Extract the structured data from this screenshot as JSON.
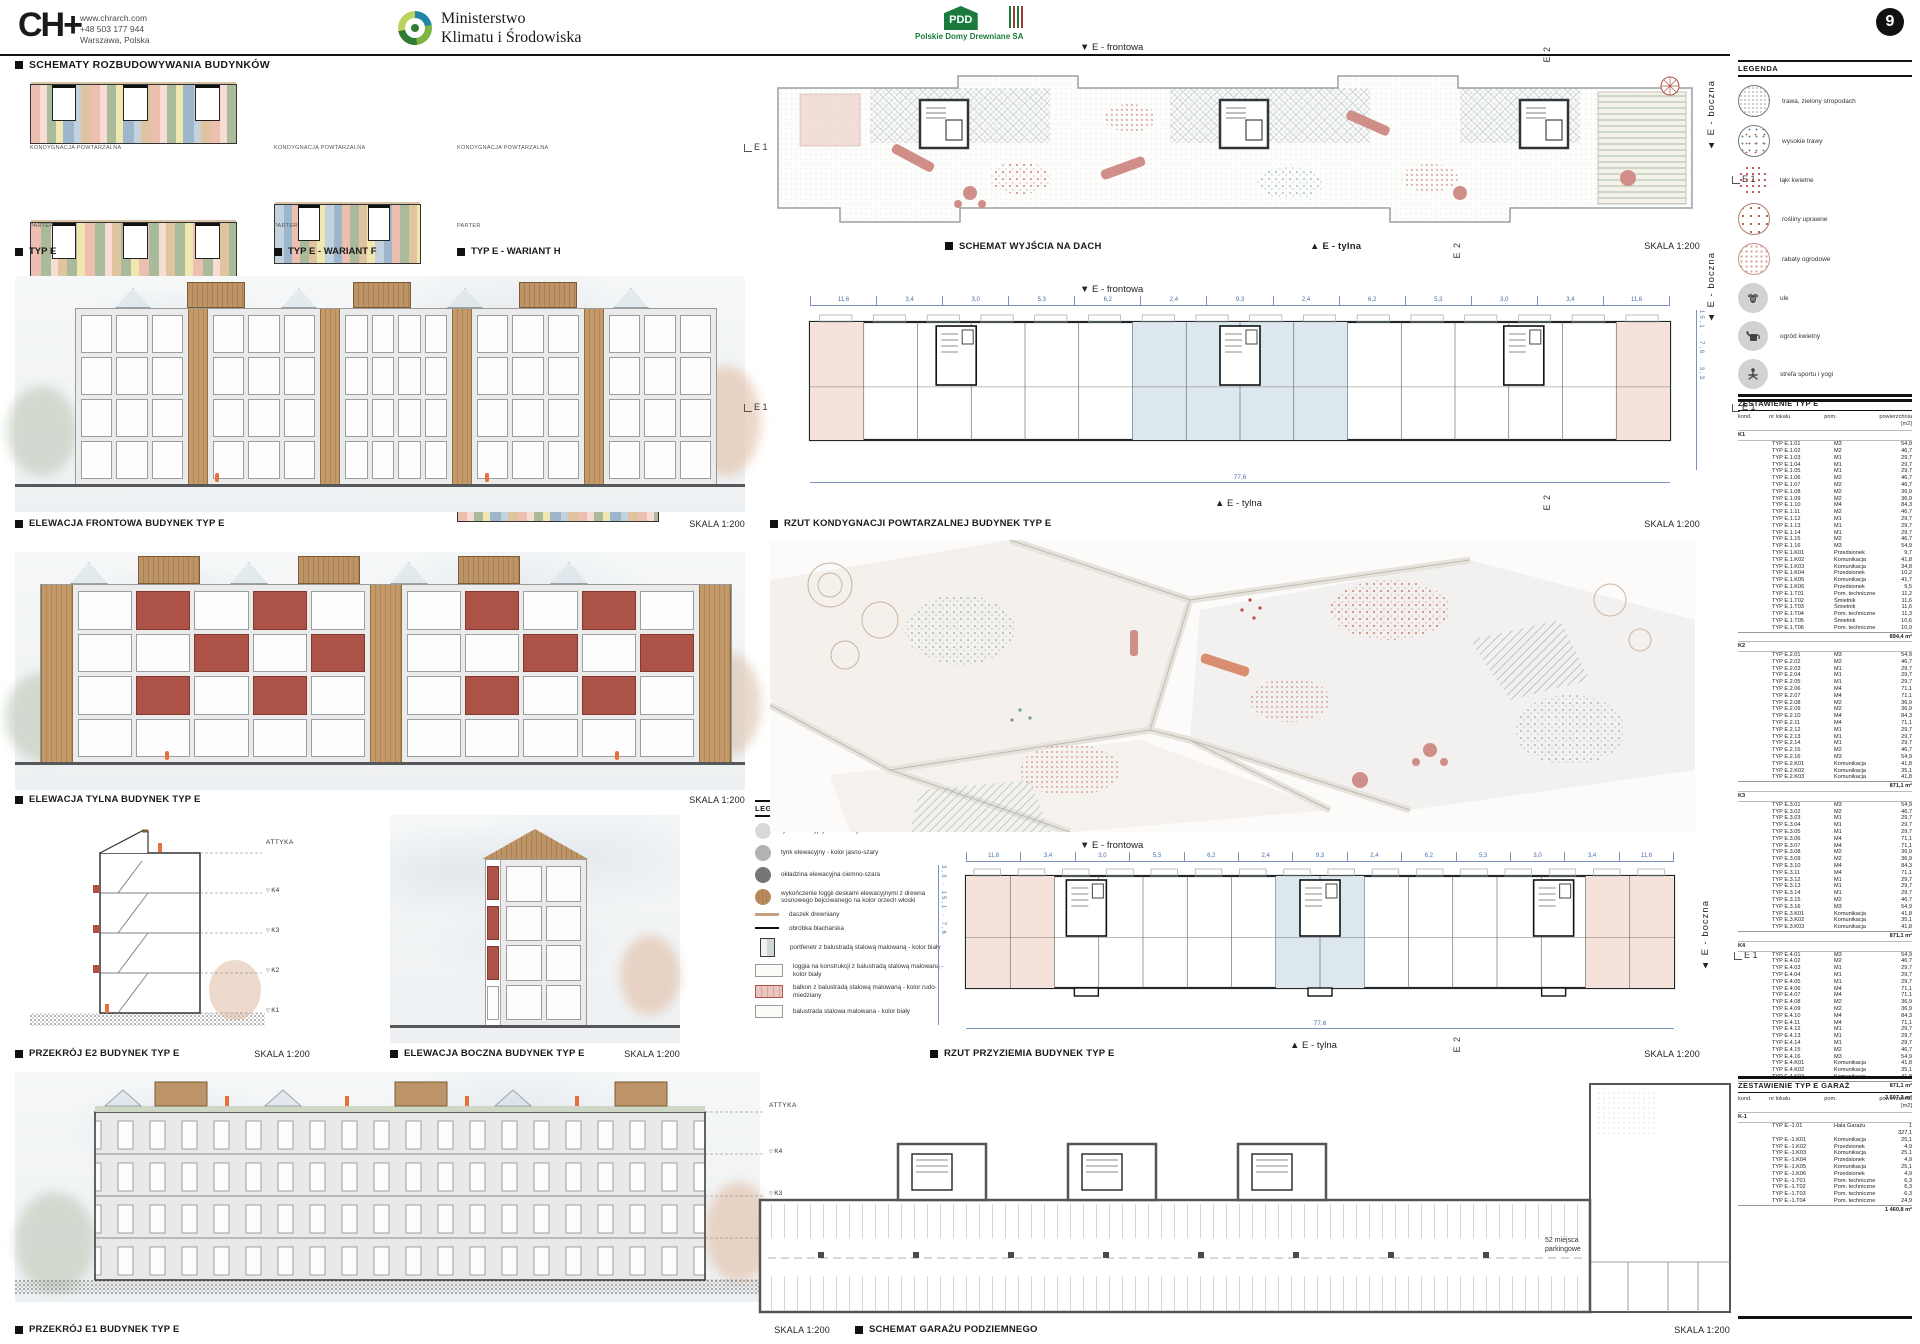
{
  "page": {
    "number": "9"
  },
  "header": {
    "logo": "CH",
    "logo_plus": "+",
    "contact": [
      "www.chrarch.com",
      "+48 503 177 944",
      "Warszawa, Polska"
    ],
    "ministry_line1": "Ministerstwo",
    "ministry_line2": "Klimatu i Środowiska",
    "pdd_abbr": "PDD",
    "pdd_name": "Polskie Domy Drewniane SA"
  },
  "titles": {
    "schematy": "SCHEMATY ROZBUDOWYWANIA BUDYNKÓW"
  },
  "figures": {
    "typ_e": {
      "caption": "TYP E"
    },
    "wariant_f": {
      "caption": "TYP E - WARIANT F"
    },
    "wariant_h": {
      "caption": "TYP E - WARIANT H"
    },
    "elew_front": {
      "caption": "ELEWACJA FRONTOWA BUDYNEK TYP E",
      "scale": "SKALA 1:200"
    },
    "elew_tylna": {
      "caption": "ELEWACJA TYLNA BUDYNEK TYP E",
      "scale": "SKALA 1:200"
    },
    "przekroj_e2": {
      "caption": "PRZEKRÓJ E2 BUDYNEK TYP E",
      "scale": "SKALA 1:200"
    },
    "elew_boczna": {
      "caption": "ELEWACJA BOCZNA BUDYNEK TYP E",
      "scale": "SKALA 1:200"
    },
    "przekroj_e1": {
      "caption": "PRZEKRÓJ E1 BUDYNEK TYP E",
      "scale": "SKALA 1:200"
    },
    "dach": {
      "caption": "SCHEMAT WYJŚCIA NA DACH",
      "scale": "SKALA 1:200"
    },
    "rzut_powt": {
      "caption": "RZUT KONDYGNACJI POWTARZALNEJ BUDYNEK TYP E",
      "scale": "SKALA 1:200"
    },
    "rzut_przyz": {
      "caption": "RZUT PRZYZIEMIA BUDYNEK TYP E",
      "scale": "SKALA 1:200"
    },
    "garaz": {
      "caption": "SCHEMAT GARAŻU PODZIEMNEGO",
      "scale": "SKALA 1:200"
    }
  },
  "labels": {
    "kondygnacja": "KONDYGNACJA POWTARZALNA",
    "parter": "PARTER",
    "frontowa": "▼ E - frontowa",
    "tylna": "▲ E - tylna",
    "boczna": "▲ E - boczna",
    "e1": "E 1",
    "e2": "E 2",
    "attyka": "ATTYKA",
    "levels": [
      "K4",
      "K3",
      "K2",
      "K1"
    ],
    "garage_note_1": "52 miejsca",
    "garage_note_2": "parkingowe"
  },
  "dims": {
    "horizontal": [
      "11,6",
      "3,4",
      "3,0",
      "5,3",
      "6,2",
      "2,4",
      "9,3",
      "2,4",
      "6,2",
      "5,3",
      "3,0",
      "3,4",
      "11,6"
    ],
    "total": "77,6",
    "vertical": [
      "3,3",
      "15,1",
      "7,6"
    ]
  },
  "legend_site": {
    "title": "LEGENDA",
    "items": [
      {
        "label": "trawa, zielony stropodach",
        "swatch": "ls-dots-fine"
      },
      {
        "label": "wysokie trawy",
        "swatch": "ls-dots-mix"
      },
      {
        "label": "łąki kwietne",
        "swatch": "ls-dots-red"
      },
      {
        "label": "rośliny uprawne",
        "swatch": "ls-dots-red-c"
      },
      {
        "label": "rabaty ogrodowe",
        "swatch": "ls-dots-pink"
      },
      {
        "label": "ule",
        "swatch": "icon-bee"
      },
      {
        "label": "ogród kwietny",
        "swatch": "icon-can"
      },
      {
        "label": "strefa sportu i yogi",
        "swatch": "icon-yoga"
      }
    ]
  },
  "legend_materials": {
    "title": "LEGENDA",
    "items": [
      {
        "label": "tynk elewacyjny - kolor biały",
        "swatch": "c-light"
      },
      {
        "label": "tynk elewacyjny - kolor jasno-szary",
        "swatch": "c-mid"
      },
      {
        "label": "okładzina elewacyjna ciemno-szara",
        "swatch": "c-dark"
      },
      {
        "label": "wykończenie loggii deskami elewacyjnymi z drewna sosnowego bejcowanego na kolor orzech włoski",
        "swatch": "c-wood"
      },
      {
        "label": "daszek drewniany",
        "swatch": "line-wood"
      },
      {
        "label": "obróbka blacharska",
        "swatch": "line-black"
      },
      {
        "label": "portfenetr z balustradą stalową malowaną - kolor biały",
        "swatch": "sw-window"
      },
      {
        "label": "loggia na konstrukcji z balustradą stalową malowaną - kolor biały",
        "swatch": "sw-box"
      },
      {
        "label": "balkon z balustradą stalową malowaną - kolor rudo-miedziany",
        "swatch": "sw-box red"
      },
      {
        "label": "balustrada stalowa malowana - kolor biały",
        "swatch": "sw-box"
      }
    ]
  },
  "tables": {
    "typ_e": {
      "title": "ZESTAWIENIE TYP E",
      "headers": [
        "kond.",
        "nr lokalu",
        "pom.",
        "powierzchnia [m2]"
      ],
      "groups": [
        {
          "kond": "K1",
          "rows": [
            [
              "TYP E.1.01",
              "M3",
              "54,9"
            ],
            [
              "TYP E.1.02",
              "M2",
              "46,7"
            ],
            [
              "TYP E.1.03",
              "M1",
              "29,7"
            ],
            [
              "TYP E.1.04",
              "M1",
              "29,7"
            ],
            [
              "TYP E.1.05",
              "M1",
              "29,7"
            ],
            [
              "TYP E.1.06",
              "M2",
              "46,7"
            ],
            [
              "TYP E.1.07",
              "M2",
              "46,7"
            ],
            [
              "TYP E.1.08",
              "M2",
              "36,9"
            ],
            [
              "TYP E.1.09",
              "M2",
              "36,9"
            ],
            [
              "TYP E.1.10",
              "M4",
              "84,3"
            ],
            [
              "TYP E.1.11",
              "M2",
              "46,7"
            ],
            [
              "TYP E.1.12",
              "M1",
              "29,7"
            ],
            [
              "TYP E.1.13",
              "M1",
              "29,7"
            ],
            [
              "TYP E.1.14",
              "M1",
              "29,7"
            ],
            [
              "TYP E.1.15",
              "M2",
              "46,7"
            ],
            [
              "TYP E.1.16",
              "M3",
              "54,9"
            ],
            [
              "TYP E.1.K01",
              "Przedsionek",
              "9,7"
            ],
            [
              "TYP E.1.K02",
              "Komunikacja",
              "41,8"
            ],
            [
              "TYP E.1.K03",
              "Komunikacja",
              "34,8"
            ],
            [
              "TYP E.1.K04",
              "Przedsionek",
              "10,2"
            ],
            [
              "TYP E.1.K05",
              "Komunikacja",
              "41,7"
            ],
            [
              "TYP E.1.K06",
              "Przedsionek",
              "9,5"
            ],
            [
              "TYP E.1.T01",
              "Pom. techniczne",
              "11,2"
            ],
            [
              "TYP E.1.T02",
              "Śmietnik",
              "11,6"
            ],
            [
              "TYP E.1.T03",
              "Śmietnik",
              "11,6"
            ],
            [
              "TYP E.1.T04",
              "Pom. techniczne",
              "11,3"
            ],
            [
              "TYP E.1.T05",
              "Śmietnik",
              "10,6"
            ],
            [
              "TYP E.1.T06",
              "Pom. techniczne",
              "10,9"
            ]
          ],
          "subtotal": "894,4 m²"
        },
        {
          "kond": "K2",
          "rows": [
            [
              "TYP E.2.01",
              "M3",
              "54,9"
            ],
            [
              "TYP E.2.02",
              "M2",
              "46,7"
            ],
            [
              "TYP E.2.03",
              "M1",
              "29,7"
            ],
            [
              "TYP E.2.04",
              "M1",
              "29,7"
            ],
            [
              "TYP E.2.05",
              "M1",
              "29,7"
            ],
            [
              "TYP E.2.06",
              "M4",
              "71,1"
            ],
            [
              "TYP E.2.07",
              "M4",
              "71,1"
            ],
            [
              "TYP E.2.08",
              "M2",
              "36,9"
            ],
            [
              "TYP E.2.09",
              "M2",
              "36,9"
            ],
            [
              "TYP E.2.10",
              "M4",
              "84,3"
            ],
            [
              "TYP E.2.11",
              "M4",
              "71,1"
            ],
            [
              "TYP E.2.12",
              "M1",
              "29,7"
            ],
            [
              "TYP E.2.13",
              "M1",
              "29,7"
            ],
            [
              "TYP E.2.14",
              "M1",
              "29,7"
            ],
            [
              "TYP E.2.15",
              "M2",
              "46,7"
            ],
            [
              "TYP E.2.16",
              "M3",
              "54,9"
            ],
            [
              "TYP E.2.K01",
              "Komunikacja",
              "41,8"
            ],
            [
              "TYP E.2.K02",
              "Komunikacja",
              "35,1"
            ],
            [
              "TYP E.2.K03",
              "Komunikacja",
              "41,8"
            ]
          ],
          "subtotal": "871,1 m²"
        },
        {
          "kond": "K3",
          "rows": [
            [
              "TYP E.3.01",
              "M3",
              "54,9"
            ],
            [
              "TYP E.3.02",
              "M2",
              "46,7"
            ],
            [
              "TYP E.3.03",
              "M1",
              "29,7"
            ],
            [
              "TYP E.3.04",
              "M1",
              "29,7"
            ],
            [
              "TYP E.3.05",
              "M1",
              "29,7"
            ],
            [
              "TYP E.3.06",
              "M4",
              "71,1"
            ],
            [
              "TYP E.3.07",
              "M4",
              "71,1"
            ],
            [
              "TYP E.3.08",
              "M2",
              "36,9"
            ],
            [
              "TYP E.3.09",
              "M2",
              "36,9"
            ],
            [
              "TYP E.3.10",
              "M4",
              "84,3"
            ],
            [
              "TYP E.3.11",
              "M4",
              "71,1"
            ],
            [
              "TYP E.3.12",
              "M1",
              "29,7"
            ],
            [
              "TYP E.3.13",
              "M1",
              "29,7"
            ],
            [
              "TYP E.3.14",
              "M1",
              "29,7"
            ],
            [
              "TYP E.3.15",
              "M2",
              "46,7"
            ],
            [
              "TYP E.3.16",
              "M3",
              "54,9"
            ],
            [
              "TYP E.3.K01",
              "Komunikacja",
              "41,8"
            ],
            [
              "TYP E.3.K02",
              "Komunikacja",
              "35,1"
            ],
            [
              "TYP E.3.K03",
              "Komunikacja",
              "41,8"
            ]
          ],
          "subtotal": "871,1 m²"
        },
        {
          "kond": "K4",
          "rows": [
            [
              "TYP E.4.01",
              "M3",
              "54,9"
            ],
            [
              "TYP E.4.02",
              "M2",
              "46,7"
            ],
            [
              "TYP E.4.03",
              "M1",
              "29,7"
            ],
            [
              "TYP E.4.04",
              "M1",
              "29,7"
            ],
            [
              "TYP E.4.05",
              "M1",
              "29,7"
            ],
            [
              "TYP E.4.06",
              "M4",
              "71,1"
            ],
            [
              "TYP E.4.07",
              "M4",
              "71,1"
            ],
            [
              "TYP E.4.08",
              "M2",
              "36,9"
            ],
            [
              "TYP E.4.09",
              "M2",
              "36,9"
            ],
            [
              "TYP E.4.10",
              "M4",
              "84,3"
            ],
            [
              "TYP E.4.11",
              "M4",
              "71,1"
            ],
            [
              "TYP E.4.12",
              "M1",
              "29,7"
            ],
            [
              "TYP E.4.13",
              "M1",
              "29,7"
            ],
            [
              "TYP E.4.14",
              "M1",
              "29,7"
            ],
            [
              "TYP E.4.15",
              "M2",
              "46,7"
            ],
            [
              "TYP E.4.16",
              "M3",
              "54,9"
            ],
            [
              "TYP E.4.K01",
              "Komunikacja",
              "41,8"
            ],
            [
              "TYP E.4.K02",
              "Komunikacja",
              "35,1"
            ],
            [
              "TYP E.4.K03",
              "Komunikacja",
              "41,8"
            ]
          ],
          "subtotal": "871,1 m²"
        }
      ],
      "total": "3 507,2 m²"
    },
    "garaz": {
      "title": "ZESTAWIENIE TYP E GARAŻ",
      "headers": [
        "kond.",
        "nr lokalu",
        "pom.",
        "powierzchnia [m2]"
      ],
      "groups": [
        {
          "kond": "K-1",
          "rows": [
            [
              "TYP E.-1.01",
              "Hala Garażu",
              "1 327,1"
            ],
            [
              "TYP E.-1.K01",
              "Komunikacja",
              "25,1"
            ],
            [
              "TYP E.-1.K02",
              "Przedsionek",
              "4,9"
            ],
            [
              "TYP E.-1.K03",
              "Komunikacja",
              "25,1"
            ],
            [
              "TYP E.-1.K04",
              "Przedsionek",
              "4,9"
            ],
            [
              "TYP E.-1.K05",
              "Komunikacja",
              "25,1"
            ],
            [
              "TYP E.-1.K06",
              "Przedsionek",
              "4,9"
            ],
            [
              "TYP E.-1.T01",
              "Pom. techniczne",
              "6,3"
            ],
            [
              "TYP E.-1.T02",
              "Pom. techniczne",
              "6,3"
            ],
            [
              "TYP E.-1.T03",
              "Pom. techniczne",
              "6,3"
            ],
            [
              "TYP E.-1.T04",
              "Pom. techniczne",
              "24,9"
            ]
          ],
          "subtotal": "1 460,8 m²"
        }
      ],
      "total": ""
    }
  },
  "colors": {
    "accent_red": "#ad5247",
    "wood": "#c49a6d",
    "dim_blue": "#4a6fa5",
    "pdd_green": "#1b7a3d",
    "pattern_teal": "#6f9b9b",
    "pattern_pink": "#dba49c",
    "figure_orange": "#e8703a"
  }
}
